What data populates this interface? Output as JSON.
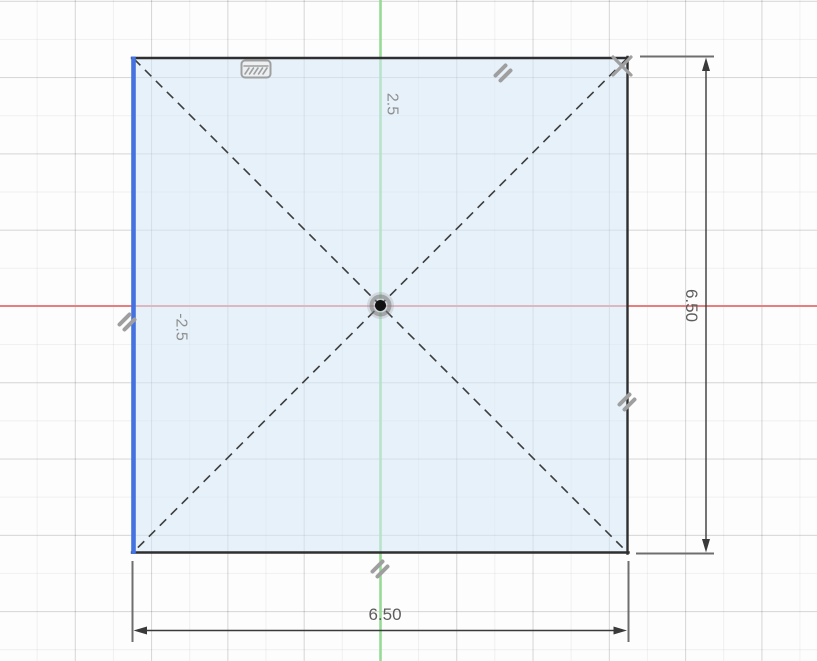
{
  "sketch": {
    "dimensions": {
      "width_value": "6.50",
      "height_value": "6.50"
    },
    "axis_labels": {
      "y_positive": "2.5",
      "x_negative": "-2.5"
    }
  },
  "colors": {
    "x_axis": "#e87f7f",
    "y_axis": "#95db95",
    "selected_edge": "#4472e0",
    "profile_fill": "rgba(213,232,247,0.55)",
    "sketch_edge": "#2f2f2f",
    "construction_line": "#3d3d3d",
    "constraint_icon": "#9f9f9f",
    "dimension_line": "#3a3a3a",
    "extension_line": "#6e6e6e",
    "dimension_text": "#5c5c5c",
    "axis_label_text": "#8f8f8f"
  },
  "icons": {
    "fixed_constraint": "fixed-constraint-icon",
    "parallel_constraint": "parallel-constraint-icon",
    "cross_constraint": "cross-constraint-icon",
    "origin_point": "origin-point-icon"
  }
}
